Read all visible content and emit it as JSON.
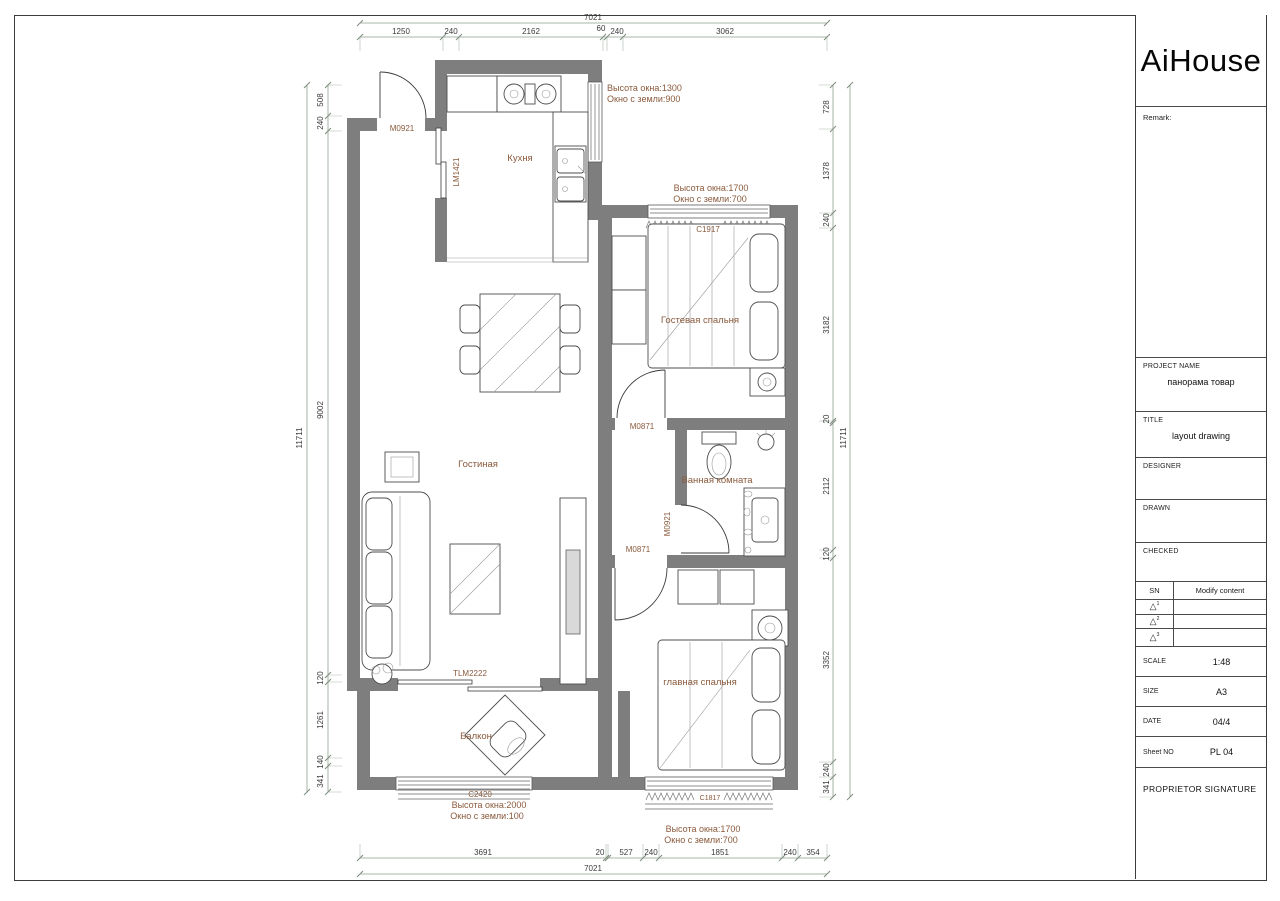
{
  "sheet": {
    "logo": "AiHouse",
    "title_block": {
      "remark_label": "Remark:",
      "project_name_label": "PROJECT NAME",
      "project_name": "панорама товар",
      "title_label": "TITLE",
      "title": "layout drawing",
      "designer_label": "DESIGNER",
      "drawn_label": "DRAWN",
      "checked_label": "CHECKED",
      "sn_label": "SN",
      "modify_label": "Modify content",
      "revision_marks": [
        "1",
        "2",
        "3"
      ],
      "triangle_icon": "△",
      "scale_label": "SCALE",
      "scale": "1:48",
      "size_label": "SIZE",
      "size": "A3",
      "date_label": "DATE",
      "date": "04/4",
      "sheet_no_label": "Sheet NO",
      "sheet_no": "PL 04",
      "signature_label": "PROPRIETOR SIGNATURE"
    }
  },
  "plan": {
    "rooms": {
      "kitchen": "Кухня",
      "living": "Гостиная",
      "guest": "Гостевая спальня",
      "bath": "Ванная комната",
      "master": "главная спальня",
      "balcony": "Балкон"
    },
    "components": {
      "entry_door": "M0921",
      "kitchen_door": "LM1421",
      "guest_door": "M0871",
      "bath_door": "M0921",
      "master_door": "M0871",
      "balcony_door": "TLM2222",
      "guest_window": "C1917",
      "balcony_window": "C2420",
      "master_window": "C1817"
    },
    "annotations": {
      "kitchen_window": {
        "line1": "Высота окна:1300",
        "line2": "Окно с земли:900"
      },
      "guest_window": {
        "line1": "Высота окна:1700",
        "line2": "Окно с земли:700"
      },
      "balcony_window": {
        "line1": "Высота окна:2000",
        "line2": "Окно с земли:100"
      },
      "master_window": {
        "line1": "Высота окна:1700",
        "line2": "Окно с земли:700"
      }
    },
    "dims": {
      "top": {
        "total": "7021",
        "segments": [
          "1250",
          "240",
          "2162",
          "60",
          "240",
          "3062"
        ]
      },
      "bottom": {
        "total": "7021",
        "segments": [
          "3691",
          "20",
          "527",
          "240",
          "1851",
          "240",
          "354"
        ]
      },
      "left": {
        "total": "11711",
        "segments": [
          "508",
          "240",
          "9002",
          "120",
          "1261",
          "140",
          "341"
        ]
      },
      "right": {
        "total": "11711",
        "segments": [
          "728",
          "1378",
          "240",
          "3182",
          "20",
          "2112",
          "120",
          "3352",
          "240",
          "341"
        ]
      }
    },
    "colors": {
      "wall": "#7e7e7e",
      "annotation": "#8a5a3c",
      "dimension_text": "#3b3b3b"
    }
  }
}
